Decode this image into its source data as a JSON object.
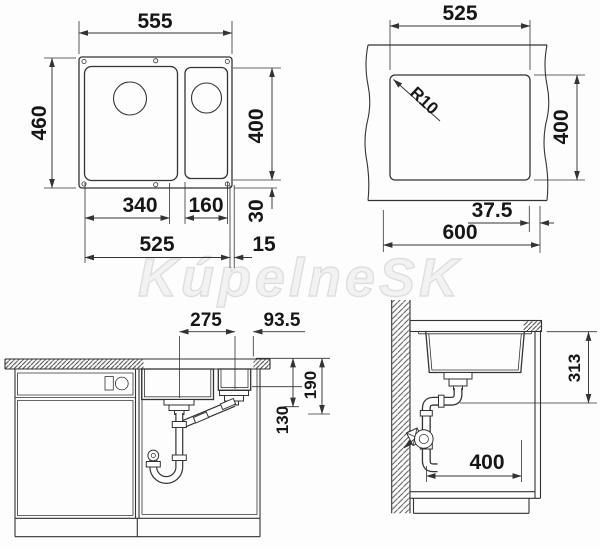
{
  "watermark": {
    "text": "KúpelneSK"
  },
  "colors": {
    "line": "#333333",
    "dim_text": "#161616",
    "watermark_stroke": "#dedede",
    "background": "#fdfdfd"
  },
  "top_view": {
    "overall_width": "555",
    "overall_depth": "460",
    "bowl_length": "400",
    "main_bowl_width": "340",
    "small_bowl_width": "160",
    "rear_offset": "30",
    "bowls_width": "525",
    "side_offset": "15"
  },
  "cutout_view": {
    "cutout_width": "525",
    "corner_radius": "R10",
    "cutout_depth": "400",
    "edge_distance": "37.5",
    "cabinet_width": "600"
  },
  "front_view": {
    "drain_spacing": "275",
    "drain_edge_distance": "93.5",
    "main_bowl_depth": "190",
    "small_bowl_depth": "130"
  },
  "side_view": {
    "install_height": "313",
    "cabinet_depth": "400"
  }
}
